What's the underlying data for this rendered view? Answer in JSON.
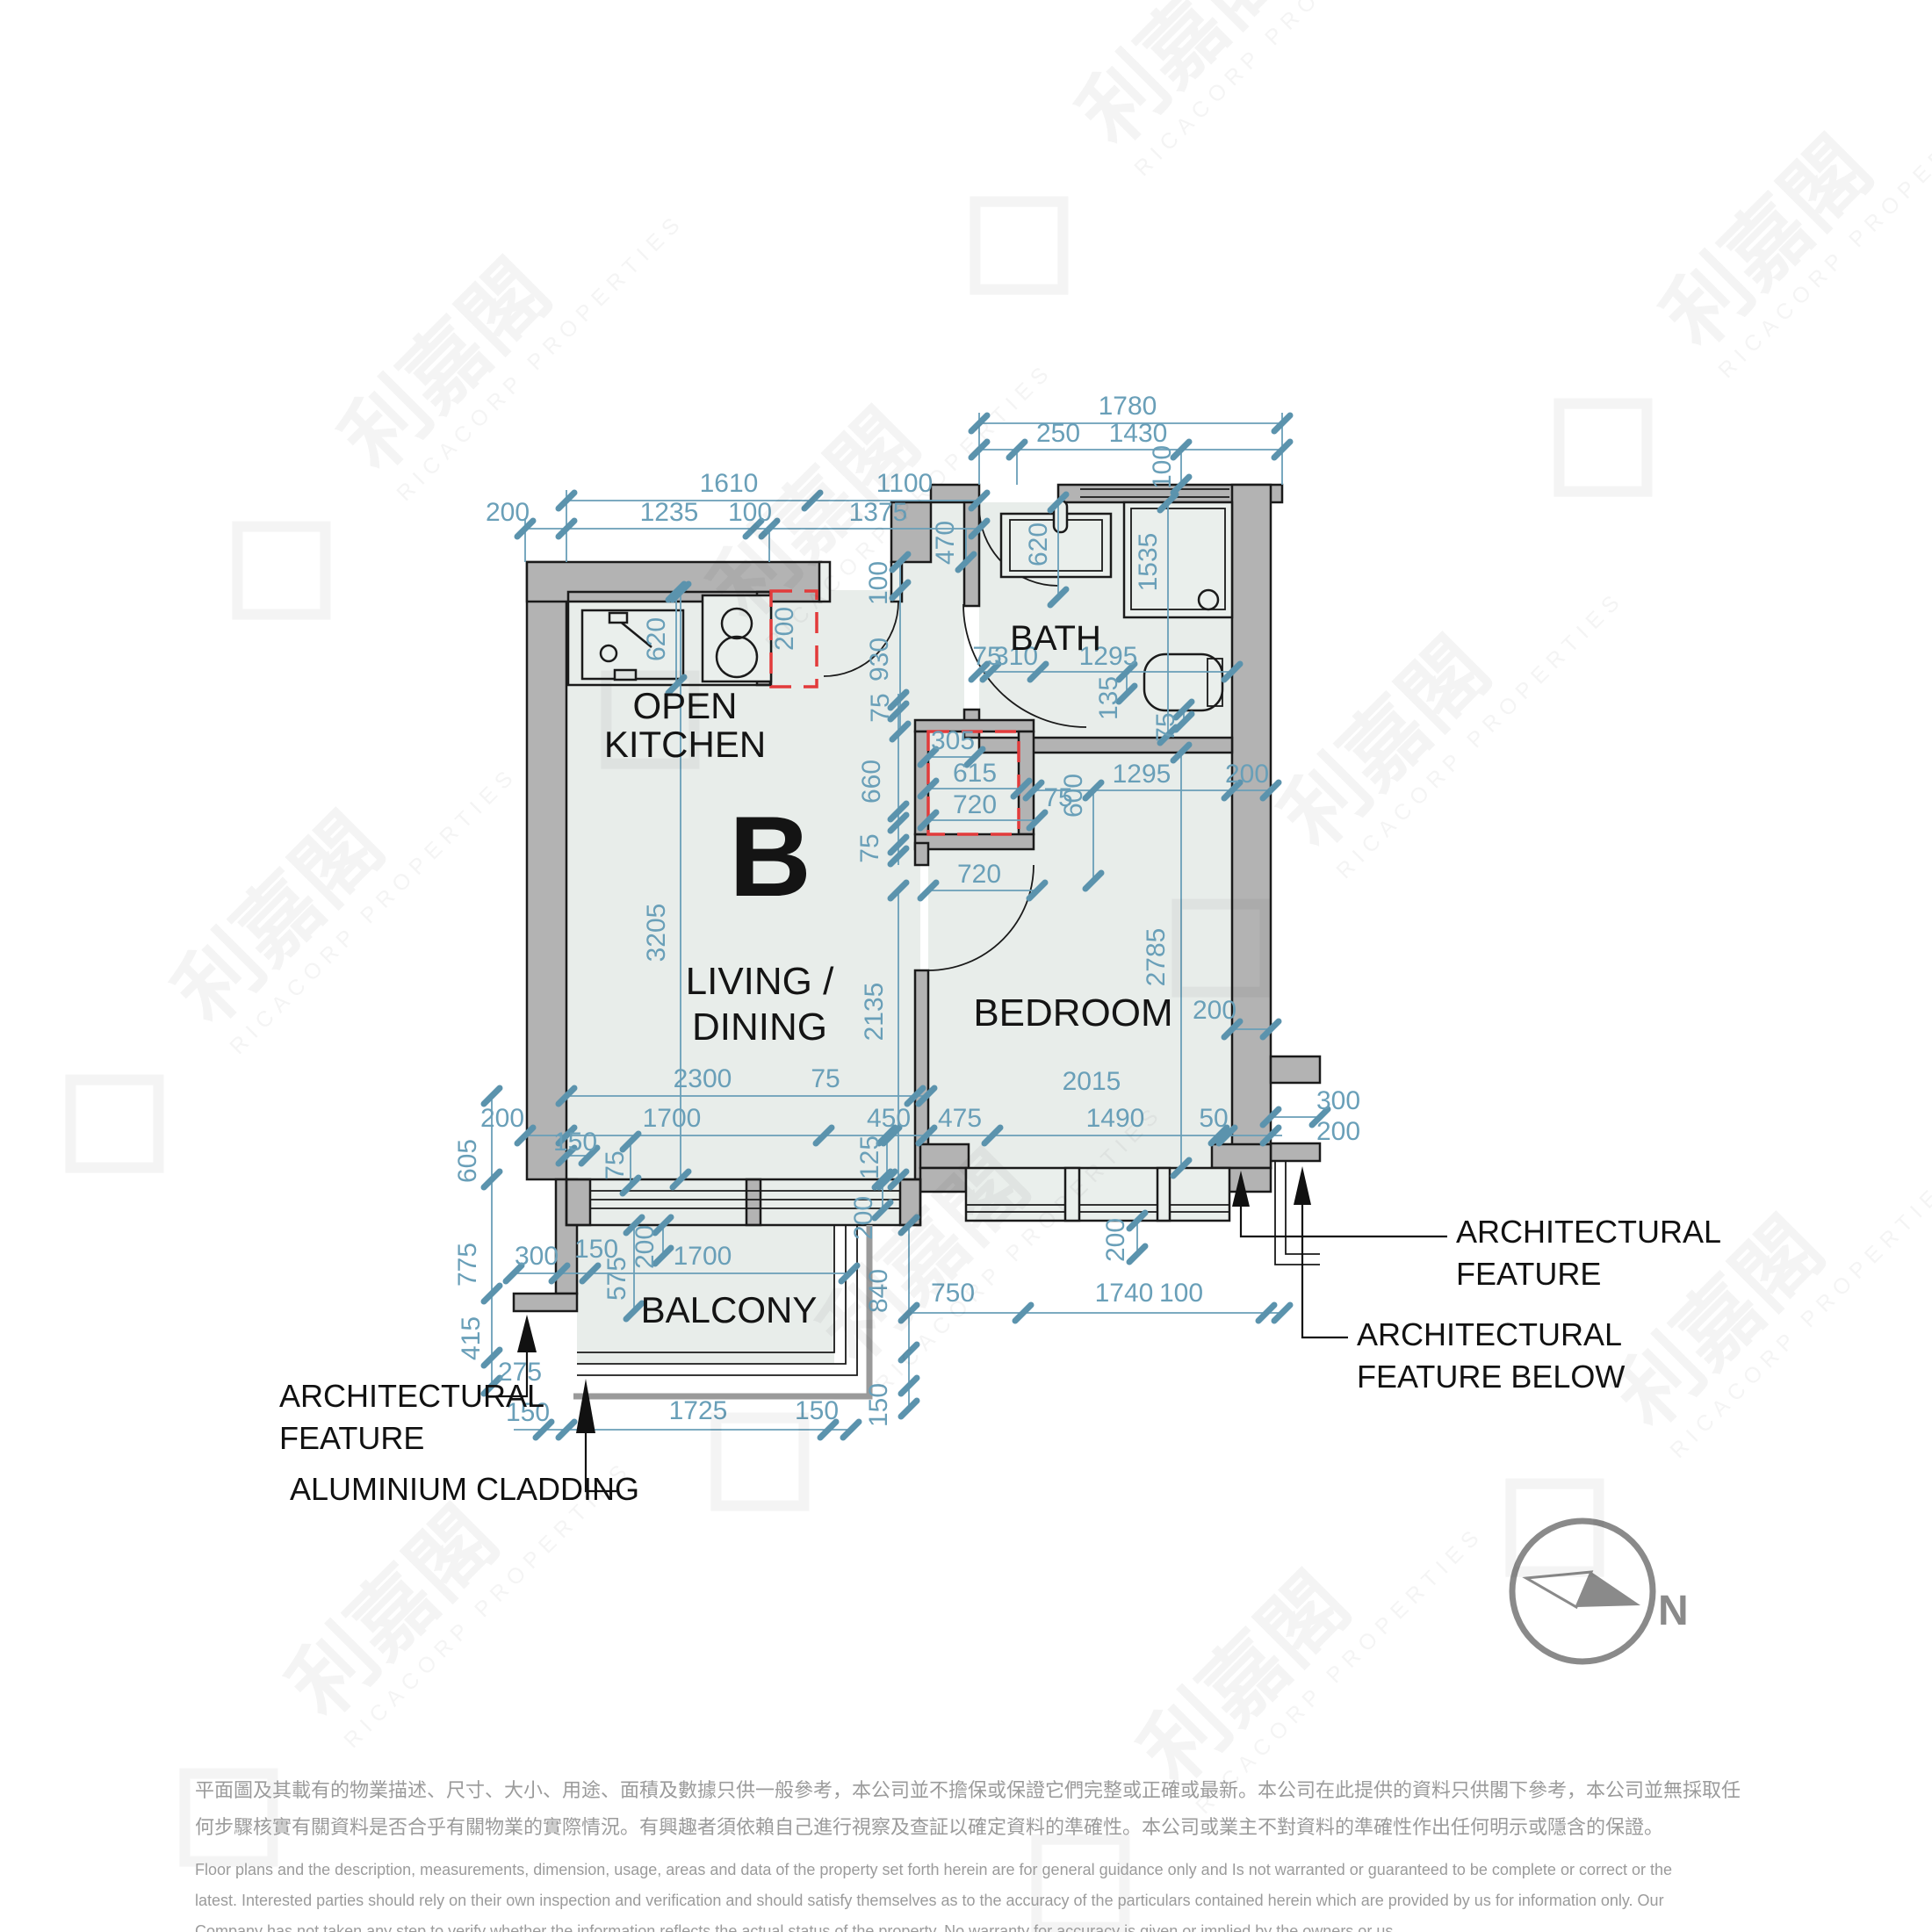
{
  "unit_label": "B",
  "rooms": {
    "kitchen_line1": "OPEN",
    "kitchen_line2": "KITCHEN",
    "living_line1": "LIVING /",
    "living_line2": "DINING",
    "bedroom": "BEDROOM",
    "bath": "BATH",
    "balcony": "BALCONY"
  },
  "callouts": {
    "left_feature_line1": "ARCHITECTURAL",
    "left_feature_line2": "FEATURE",
    "aluminium_cladding": "ALUMINIUM CLADDING",
    "right_feature_line1": "ARCHITECTURAL",
    "right_feature_line2": "FEATURE",
    "right_below_line1": "ARCHITECTURAL",
    "right_below_line2": "FEATURE BELOW"
  },
  "compass": {
    "north_label": "N"
  },
  "watermark": {
    "logo_text": "利嘉閣",
    "brand": "RICACORP PROPERTIES"
  },
  "colors": {
    "dimension_blue": "#699fb8",
    "wall_gray": "#b3b3b3",
    "room_fill": "#e8edea",
    "red_dashed": "#e23b3b",
    "compass_gray": "#8a8a8a",
    "disclaimer_gray": "#9b9b9b"
  },
  "disclaimer": {
    "zh1": "平面圖及其載有的物業描述、尺寸、大小、用途、面積及數據只供一般參考，本公司並不擔保或保證它們完整或正確或最新。本公司在此提供的資料只供閣下參考，本公司並無採取任",
    "zh2": "何步驟核實有關資料是否合乎有關物業的實際情況。有興趣者須依賴自己進行視察及查証以確定資料的準確性。本公司或業主不對資料的準確性作出任何明示或隱含的保證。",
    "en1": "Floor plans and the description, measurements, dimension, usage, areas and data of the property set forth herein are for general guidance only and Is not warranted or guaranteed to be complete or correct or the",
    "en2": "latest. Interested parties should rely on their own inspection and verification and should satisfy themselves as to the accuracy of the particulars contained herein which are provided by us for information only.  Our",
    "en3": "Company has not taken any step to verify whether the information reflects the actual status of the property.  No warranty for accuracy is given or implied by the owners or us."
  },
  "dims": [
    "1780",
    "250",
    "1430",
    "100",
    "1610",
    "1100",
    "200",
    "1235",
    "100",
    "1375",
    "470",
    "620",
    "200",
    "100",
    "930",
    "620",
    "1535",
    "75",
    "310",
    "1295",
    "135",
    "75",
    "75",
    "660",
    "75",
    "305",
    "615",
    "720",
    "75",
    "600",
    "1295",
    "200",
    "720",
    "3205",
    "2135",
    "2785",
    "200",
    "2300",
    "75",
    "2015",
    "200",
    "1700",
    "450",
    "475",
    "1490",
    "50",
    "300",
    "200",
    "150",
    "75",
    "125",
    "605",
    "775",
    "415",
    "275",
    "300",
    "150",
    "575",
    "200",
    "1700",
    "200",
    "840",
    "150",
    "150",
    "1725",
    "150",
    "750",
    "1740",
    "100",
    "200"
  ]
}
